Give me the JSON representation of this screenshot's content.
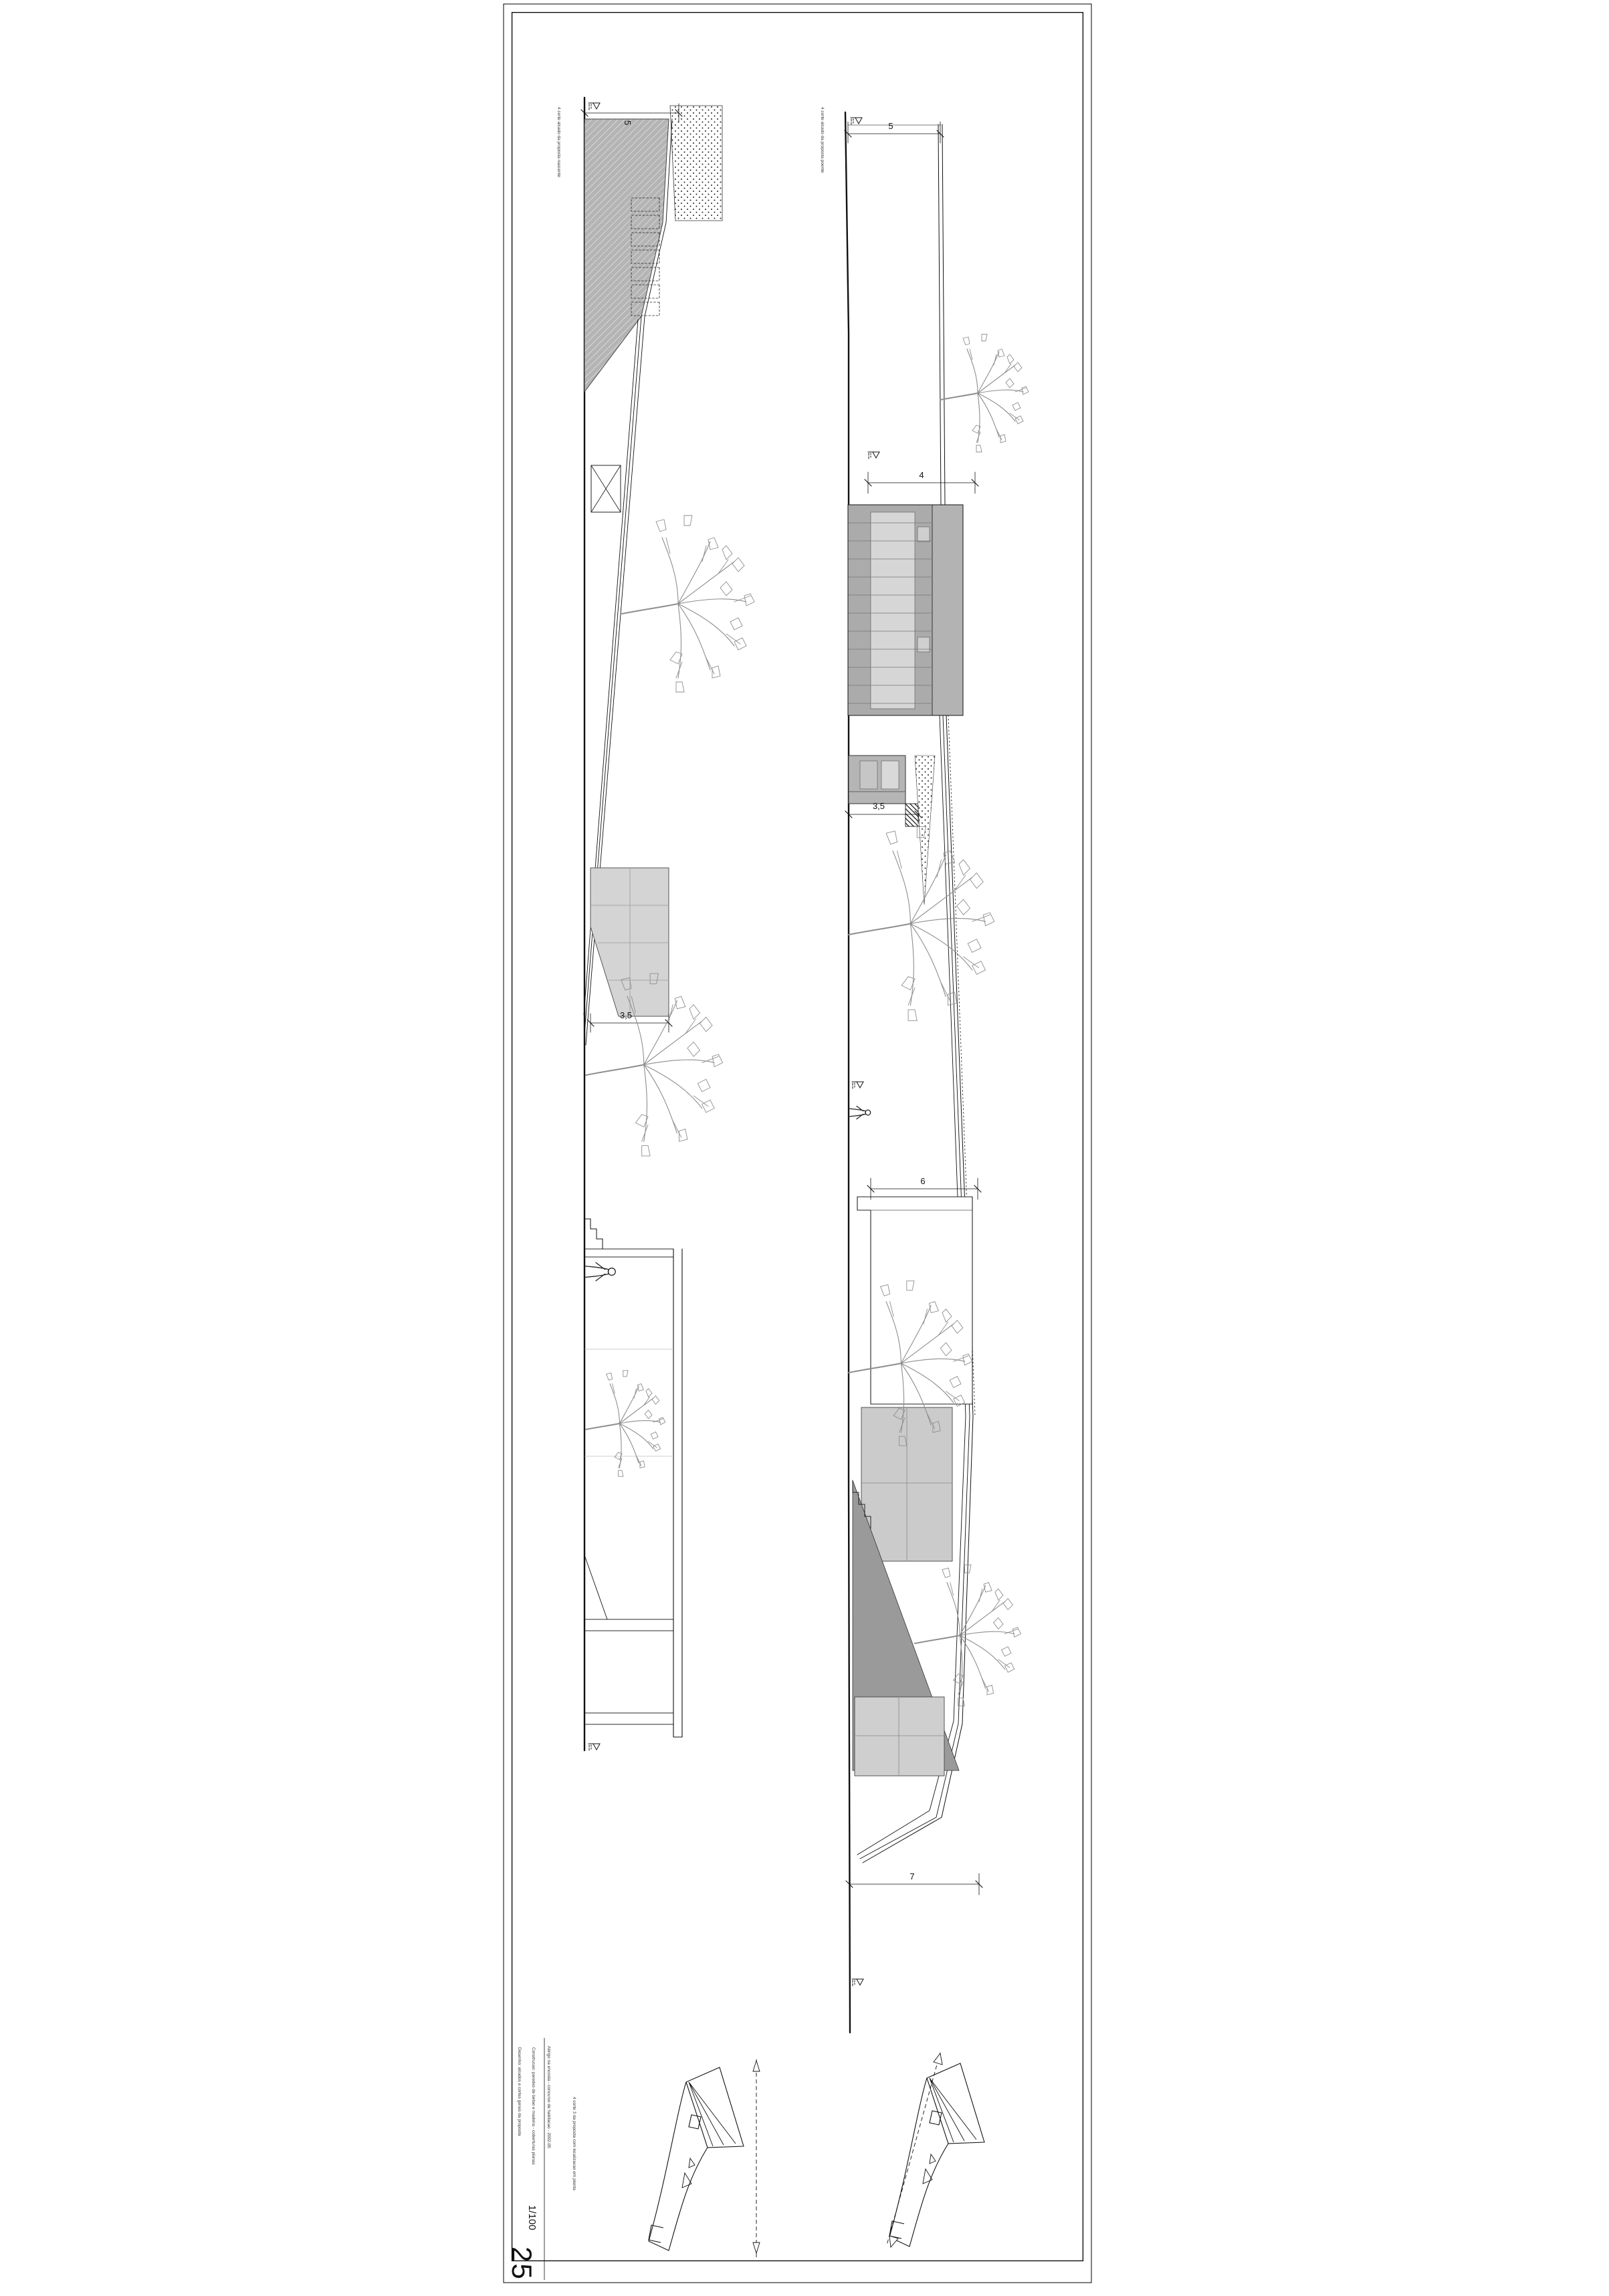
{
  "title_block": {
    "line1": "Abrigo na encosta - concurso de habitacao - 2002.05",
    "line2": "Construcao: paredes de betao e madeira - coberturas planas",
    "line3": "Desenho: alcados e cortes gerais da proposta",
    "scale": "1/100",
    "sheet_number": "25"
  },
  "captions": {
    "drawing_a": "4 corte alcado da proposta poente",
    "drawing_b": "4 corte alcado da proposta nascente",
    "site_plans": "4 corte 3 da proposta com localizacao em planta"
  },
  "dimensions": {
    "a": [
      "5",
      "4",
      "3,5",
      "6",
      "7"
    ],
    "b": [
      "5",
      "3,5"
    ]
  },
  "colors": {
    "line": "#1a1a1a",
    "grey_mass": "#ababab",
    "grey_band": "#b3b3b3",
    "light_panel": "#d6d6d6",
    "terrace": "#d4d4d4",
    "wedge": "#9a9a9a",
    "tree": "#8e8e8e"
  }
}
